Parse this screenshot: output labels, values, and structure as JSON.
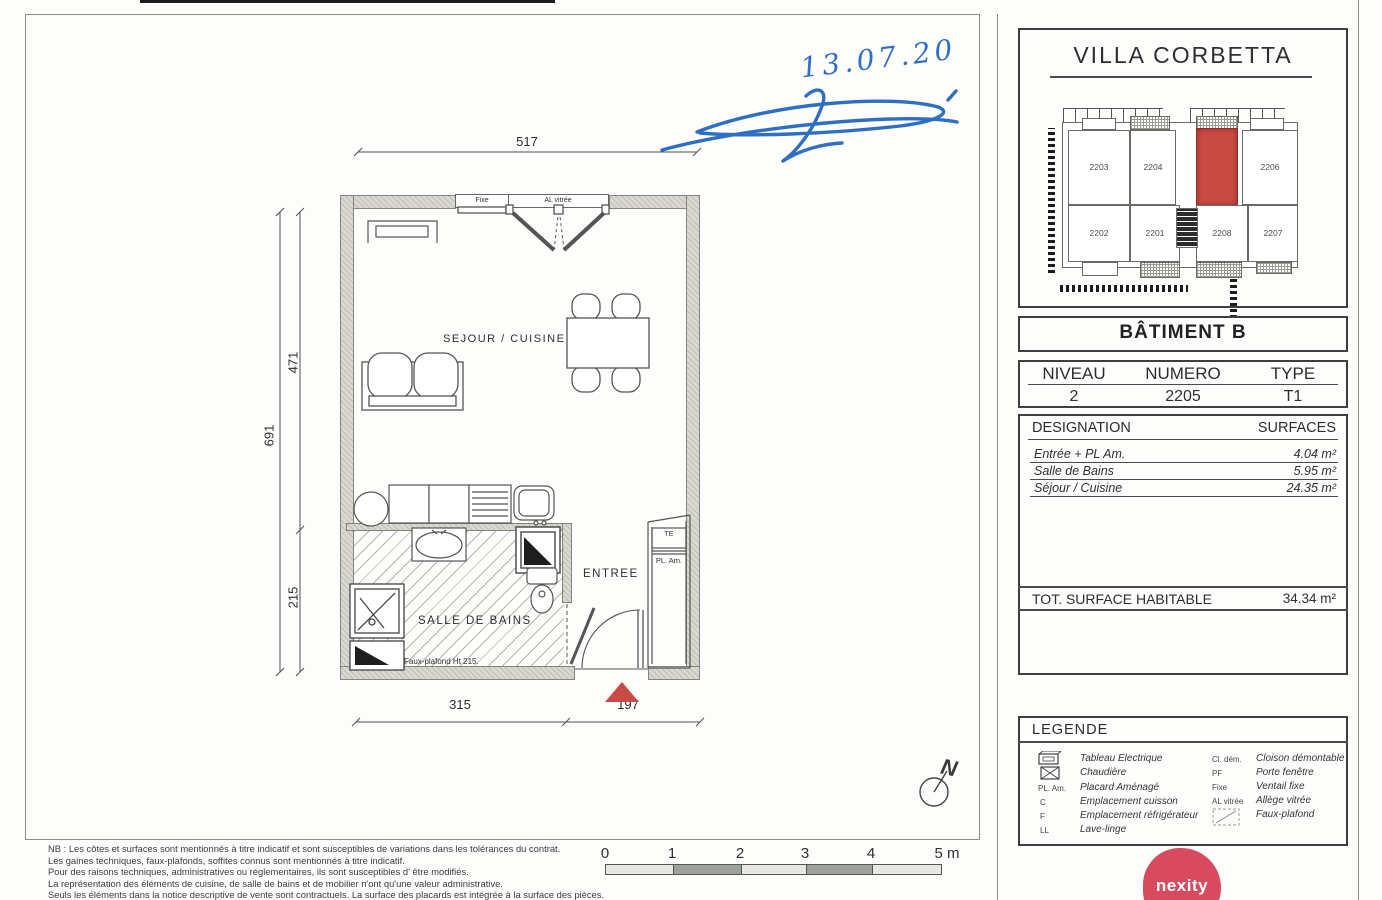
{
  "handwriting": {
    "date": "13.07.20"
  },
  "plan": {
    "dims": {
      "top": "517",
      "left_total": "691",
      "left_upper": "471",
      "left_lower": "215",
      "bottom_left": "315",
      "bottom_right": "197"
    },
    "labels": {
      "sejour_cuisine": "SEJOUR / CUISINE",
      "salle_de_bains": "SALLE DE BAINS",
      "entree": "ENTREE",
      "faux_plafond": "Faux-plafond  Ht  215.",
      "fixe": "Fixe",
      "al_vitree": "AL vitrée",
      "cu": "CU",
      "f": "F",
      "c": "C",
      "lv": "LV",
      "te": "TE",
      "pl_am": "PL. Am.",
      "north": "N"
    }
  },
  "panel": {
    "residence": "VILLA CORBETTA",
    "site_units": {
      "u2203": "2203",
      "u2204": "2204",
      "u2206": "2206",
      "u2202": "2202",
      "u2201": "2201",
      "u2208": "2208",
      "u2207": "2207"
    },
    "batiment": "BÂTIMENT B",
    "info": {
      "h_niveau": "NIVEAU",
      "h_numero": "NUMERO",
      "h_type": "TYPE",
      "niveau": "2",
      "numero": "2205",
      "type": "T1"
    },
    "surfaces": {
      "h_designation": "DESIGNATION",
      "h_surfaces": "SURFACES",
      "rows": [
        {
          "name": "Entrée + PL Am.",
          "value": "4.04 m²"
        },
        {
          "name": "Salle de Bains",
          "value": "5.95 m²"
        },
        {
          "name": "Séjour / Cuisine",
          "value": "24.35 m²"
        }
      ],
      "total_label": "TOT. SURFACE HABITABLE",
      "total_value": "34.34 m²"
    },
    "legend": {
      "title": "LEGENDE",
      "left": [
        {
          "sym": "",
          "label": "Tableau Electrique"
        },
        {
          "sym": "",
          "label": "Chaudière"
        },
        {
          "sym": "PL. Am.",
          "label": "Placard Aménagé"
        },
        {
          "sym": "C",
          "label": "Emplacement cuisson"
        },
        {
          "sym": "F",
          "label": "Emplacement réfrigérateur"
        },
        {
          "sym": "LL",
          "label": "Lave-linge"
        }
      ],
      "right": [
        {
          "sym": "Cl. dém.",
          "label": "Cloison démontable"
        },
        {
          "sym": "PF",
          "label": "Porte fenêtre"
        },
        {
          "sym": "Fixe",
          "label": "Ventail fixe"
        },
        {
          "sym": "AL vitrée",
          "label": "Allège vitrée"
        },
        {
          "sym": "",
          "label": "Faux-plafond"
        }
      ]
    },
    "brand": "nexity"
  },
  "notes": [
    "NB : Les côtes et surfaces sont mentionnés à titre indicatif et sont susceptibles de variations dans les tolérances du contrat.",
    "Les gaines techniques, faux-plafonds, soffites connus sont mentionnés à titre indicatif.",
    "Pour des raisons techniques, administratives ou réglementaires, ils sont susceptibles d' être modifiés.",
    "La représentation des éléments de cuisine, de salle de bains et de mobilier n'ont qu'une valeur administrative.",
    "Seuls les éléments dans la notice descriptive de vente sont contractuels. La surface des placards est intégrée à la surface des pièces."
  ],
  "scale": {
    "t0": "0",
    "t1": "1",
    "t2": "2",
    "t3": "3",
    "t4": "4",
    "t5": "5 m"
  },
  "colors": {
    "highlight_red": "#c94b44",
    "brand_pink": "#d84b5e",
    "ink_blue": "#2f6fc3"
  }
}
